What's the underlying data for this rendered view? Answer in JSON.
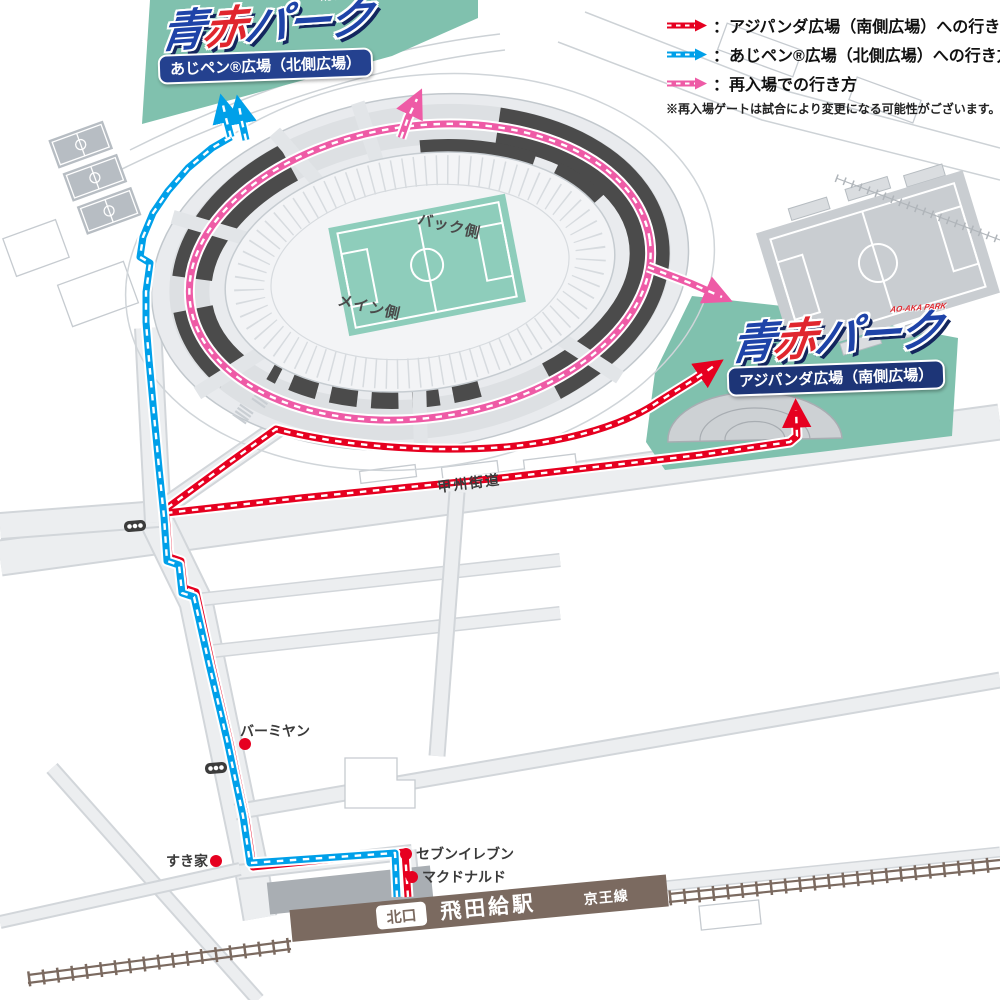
{
  "colors": {
    "route-red": "#e60020",
    "route-blue": "#00a0e9",
    "route-pink": "#ee5ba6",
    "park-teal": "#80c1ae",
    "pitch-teal": "#8ecdbb",
    "stadium-dark": "#4b4b4b",
    "station-brown": "#7b6a60",
    "badge-blue": "#24418f",
    "badge-navy": "#1d3577",
    "logo-blue": "#1e43a8",
    "logo-red": "#e0262e"
  },
  "legend": {
    "south": {
      "label": "：アジパンダ広場（南側広場）への行き方"
    },
    "north": {
      "label": "：あじペン®広場（北側広場）への行き方"
    },
    "reentry": {
      "label": "：再入場での行き方"
    },
    "note": "※再入場ゲートは試合により変更になる可能性がございます。"
  },
  "logos": {
    "north": {
      "blue": "青",
      "red": "赤",
      "suffix": "パーク",
      "small": "AO-AKA PARK",
      "badge": "あじペン®広場（北側広場）"
    },
    "south": {
      "blue": "青",
      "red": "赤",
      "suffix": "パーク",
      "small": "AO-AKA PARK",
      "badge": "アジパンダ広場（南側広場）"
    }
  },
  "stadium": {
    "back_label": "バック側",
    "main_label": "メイン側"
  },
  "roads": {
    "koshu_kaido": "甲州街道"
  },
  "landmarks": {
    "bamiyan": "バーミヤン",
    "sukiya": "すき家",
    "seven_eleven": "セブンイレブン",
    "mcdonalds": "マクドナルド"
  },
  "station": {
    "north_exit": "北口",
    "name": "飛田給駅",
    "line": "京王線"
  }
}
